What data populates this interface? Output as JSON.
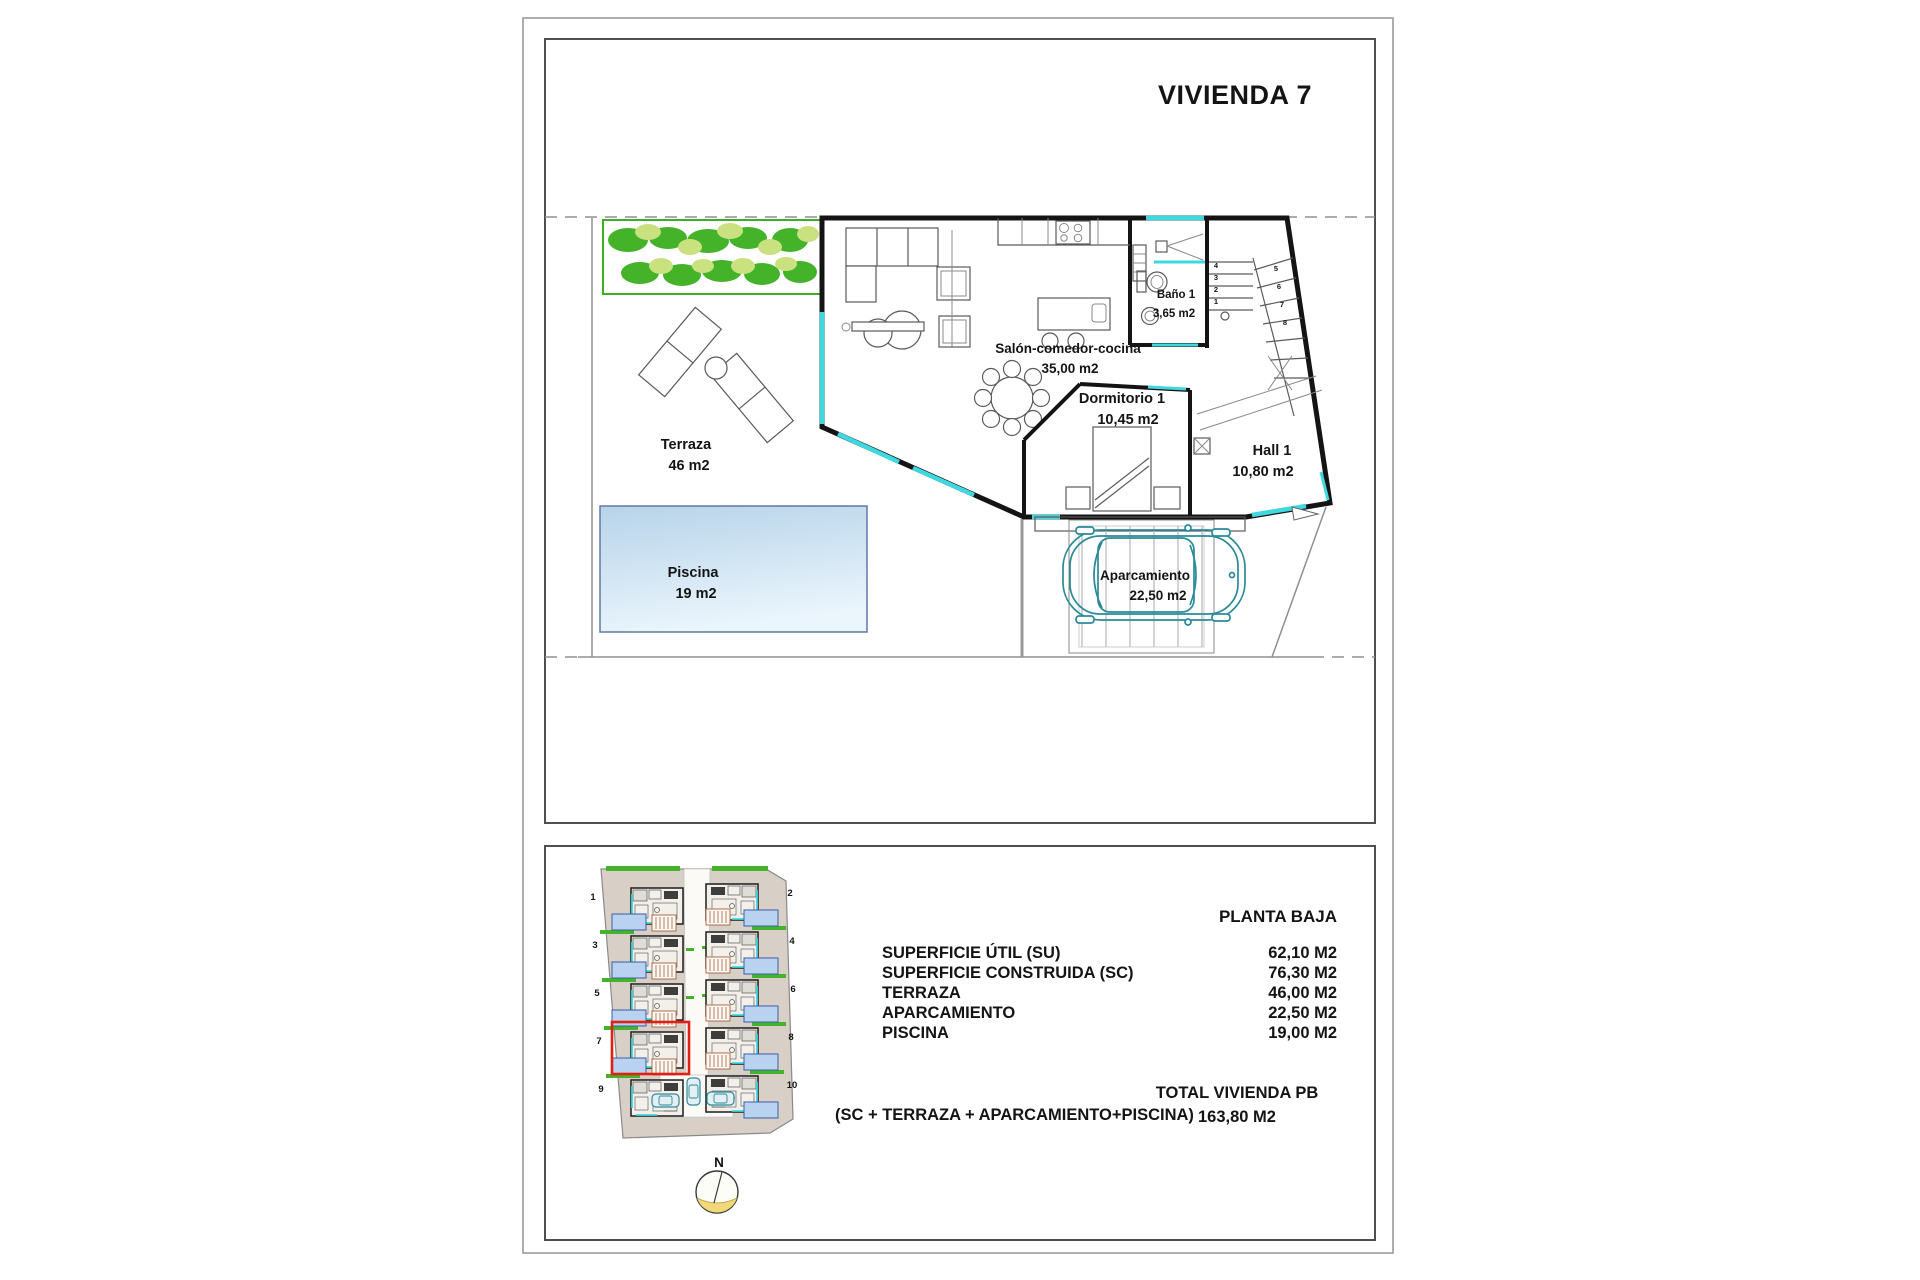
{
  "title": "VIVIENDA 7",
  "plan": {
    "terraza": {
      "name": "Terraza",
      "area": "46 m2"
    },
    "piscina": {
      "name": "Piscina",
      "area": "19 m2"
    },
    "salon": {
      "name": "Salón-comedor-cocina",
      "area": "35,00 m2"
    },
    "bano": {
      "name": "Baño 1",
      "area": "3,65 m2"
    },
    "dormitorio": {
      "name": "Dormitorio 1",
      "area": "10,45 m2"
    },
    "hall": {
      "name": "Hall 1",
      "area": "10,80 m2"
    },
    "aparcamiento": {
      "name": "Aparcamiento",
      "area": "22,50 m2"
    },
    "stairs": {
      "steps": [
        "1",
        "2",
        "3",
        "4",
        "5",
        "6",
        "7",
        "8"
      ]
    }
  },
  "site": {
    "plots": [
      "1",
      "2",
      "3",
      "4",
      "5",
      "6",
      "7",
      "8",
      "9",
      "10"
    ],
    "highlighted_plot": "7",
    "north": "N"
  },
  "summary": {
    "header": "PLANTA BAJA",
    "rows": [
      {
        "label": "SUPERFICIE ÚTIL (SU)",
        "value": "62,10 M2"
      },
      {
        "label": "SUPERFICIE CONSTRUIDA (SC)",
        "value": "76,30 M2"
      },
      {
        "label": "TERRAZA",
        "value": "46,00 M2"
      },
      {
        "label": "APARCAMIENTO",
        "value": "22,50 M2"
      },
      {
        "label": "PISCINA",
        "value": "19,00 M2"
      }
    ],
    "formula": "(SC + TERRAZA + APARCAMIENTO+PISCINA)",
    "total_label": "TOTAL VIVIENDA PB",
    "total_value": "163,80 M2"
  },
  "colors": {
    "glass": "#3fd8e0",
    "car-outline": "#2b8a99",
    "pool-border": "#6077a8",
    "highlight": "#e02010",
    "vegetation": "#44b32a",
    "site-ground": "#d8cfc6",
    "mini-pool": "#b9d2f0"
  }
}
